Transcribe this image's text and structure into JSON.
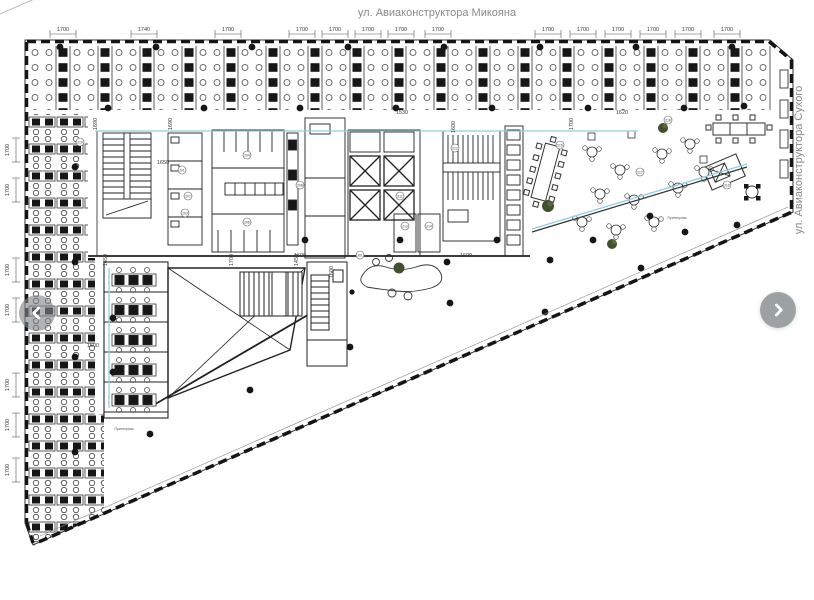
{
  "street_labels": {
    "top": "ул. Авиаконструктора Микояна",
    "right": "ул. Авиаконструктора Сухого",
    "site": "ЖК Лица"
  },
  "nav": {
    "prev": "previous image",
    "next": "next image"
  },
  "colors": {
    "line": "#1f1f1f",
    "zone_boundary_cyan": "#8ecfe2",
    "plant_green": "#42502e",
    "nav_button_gray": "#979c9f",
    "dim_text": "#3a3a3a",
    "street_text": "#8a8a8a"
  },
  "dimensions": {
    "top": [
      {
        "v": "1700",
        "x": 63
      },
      {
        "v": "1740",
        "x": 144
      },
      {
        "v": "1700",
        "x": 228
      },
      {
        "v": "1700",
        "x": 302
      },
      {
        "v": "1700",
        "x": 335
      },
      {
        "v": "1700",
        "x": 368
      },
      {
        "v": "1700",
        "x": 401
      },
      {
        "v": "1700",
        "x": 438
      },
      {
        "v": "1700",
        "x": 548
      },
      {
        "v": "1700",
        "x": 583
      },
      {
        "v": "1700",
        "x": 618
      },
      {
        "v": "1700",
        "x": 653
      },
      {
        "v": "1700",
        "x": 688
      },
      {
        "v": "1700",
        "x": 727
      }
    ],
    "left": [
      {
        "v": "1700",
        "y": 150
      },
      {
        "v": "1700",
        "y": 190
      },
      {
        "v": "1700",
        "y": 270
      },
      {
        "v": "1700",
        "y": 310
      },
      {
        "v": "1700",
        "y": 385
      },
      {
        "v": "1700",
        "y": 425
      },
      {
        "v": "1700",
        "y": 470
      }
    ],
    "diagonal": [
      {
        "v": "1700",
        "x": 150
      },
      {
        "v": "1700",
        "x": 222
      },
      {
        "v": "1700",
        "x": 294
      },
      {
        "v": "1700",
        "x": 366
      },
      {
        "v": "1770",
        "x": 438
      },
      {
        "v": "1700",
        "x": 510
      },
      {
        "v": "1700",
        "x": 582
      },
      {
        "v": "1700",
        "x": 654
      },
      {
        "v": "1700",
        "x": 726
      }
    ],
    "inner": [
      {
        "v": "1530",
        "x": 402,
        "y": 114,
        "rot": 0
      },
      {
        "v": "1620",
        "x": 622,
        "y": 114,
        "rot": 0
      },
      {
        "v": "1600",
        "x": 455,
        "y": 127,
        "rot": -90
      },
      {
        "v": "1690",
        "x": 97,
        "y": 124,
        "rot": -90
      },
      {
        "v": "1690",
        "x": 172,
        "y": 124,
        "rot": -90
      },
      {
        "v": "1700",
        "x": 573,
        "y": 124,
        "rot": -90
      },
      {
        "v": "1650",
        "x": 163,
        "y": 164,
        "rot": 0
      },
      {
        "v": "1600",
        "x": 300,
        "y": 257,
        "rot": 0
      },
      {
        "v": "1600",
        "x": 466,
        "y": 257,
        "rot": 0
      },
      {
        "v": "1600",
        "x": 333,
        "y": 272,
        "rot": -90
      },
      {
        "v": "1600",
        "x": 93,
        "y": 347,
        "rot": 0
      },
      {
        "v": "1450",
        "x": 107,
        "y": 260,
        "rot": -90
      },
      {
        "v": "1700",
        "x": 233,
        "y": 260,
        "rot": -90
      },
      {
        "v": "1450",
        "x": 298,
        "y": 260,
        "rot": -90
      }
    ]
  },
  "room_numbers": [
    {
      "n": "201",
      "x": 182,
      "y": 170
    },
    {
      "n": "203",
      "x": 185,
      "y": 213
    },
    {
      "n": "204",
      "x": 247,
      "y": 155
    },
    {
      "n": "206",
      "x": 247,
      "y": 222
    },
    {
      "n": "207",
      "x": 188,
      "y": 196
    },
    {
      "n": "208",
      "x": 300,
      "y": 185
    },
    {
      "n": "210",
      "x": 80,
      "y": 142
    },
    {
      "n": "211",
      "x": 400,
      "y": 196
    },
    {
      "n": "212",
      "x": 455,
      "y": 148
    },
    {
      "n": "213",
      "x": 405,
      "y": 226
    },
    {
      "n": "214",
      "x": 429,
      "y": 226
    },
    {
      "n": "216",
      "x": 560,
      "y": 145
    },
    {
      "n": "217",
      "x": 640,
      "y": 172
    },
    {
      "n": "218",
      "x": 668,
      "y": 120
    },
    {
      "n": "219",
      "x": 727,
      "y": 185
    },
    {
      "n": "301",
      "x": 360,
      "y": 255
    }
  ],
  "service_labels": [
    {
      "text": "Принтерная",
      "x": 124,
      "y": 430
    },
    {
      "text": "Принтерная",
      "x": 677,
      "y": 219
    }
  ]
}
